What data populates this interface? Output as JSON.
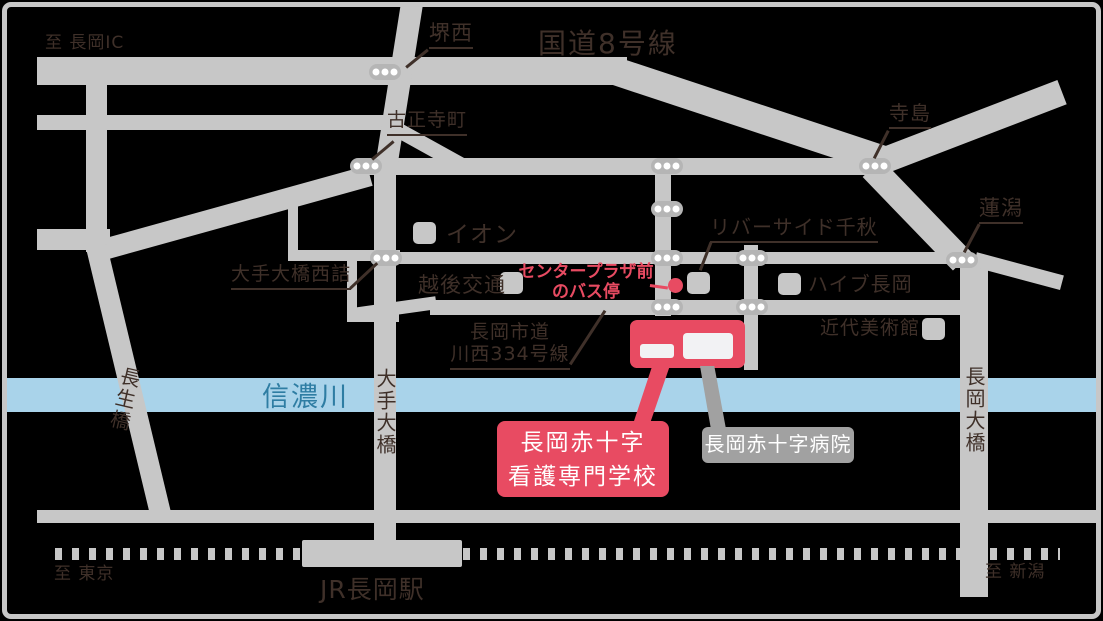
{
  "colors": {
    "road": "#c7c7c7",
    "river": "#a9d3ea",
    "river_text": "#2e7da3",
    "accent_red": "#e84b62",
    "map_text": "#3f3029",
    "hospital_gray": "#a1a1a1",
    "bus_pill": "#b5b5b5",
    "building_inner": "#f2f2f4"
  },
  "map": {
    "directions": {
      "to_nagaoka_ic": "至 長岡IC",
      "to_tokyo": "至 東京",
      "to_niigata": "至 新潟"
    },
    "roads": {
      "route8": "国道8号線",
      "city_road_line1": "長岡市道",
      "city_road_line2": "川西334号線"
    },
    "rail": {
      "jr_station": "JR長岡駅"
    },
    "river": {
      "name": "信濃川"
    },
    "bridges": {
      "chosei": "長生橋",
      "ote": "大手大橋",
      "nagaoka": "長岡大橋"
    },
    "bus_stops": {
      "sakai_nishi": "堺西",
      "koshoji_cho": "古正寺町",
      "terajima": "寺島",
      "hasugata": "蓮潟",
      "ote_ohashi_nishizume": "大手大橋西詰",
      "center_plaza_line1": "センタープラザ前",
      "center_plaza_line2": "のバス停"
    },
    "landmarks": {
      "aeon": "イオン",
      "echigo_kotsu": "越後交通",
      "riverside_senshu": "リバーサイド千秋",
      "hive_nagaoka": "ハイブ長岡",
      "museum": "近代美術館"
    },
    "destinations": {
      "school_line1": "長岡赤十字",
      "school_line2": "看護専門学校",
      "hospital": "長岡赤十字病院"
    }
  }
}
